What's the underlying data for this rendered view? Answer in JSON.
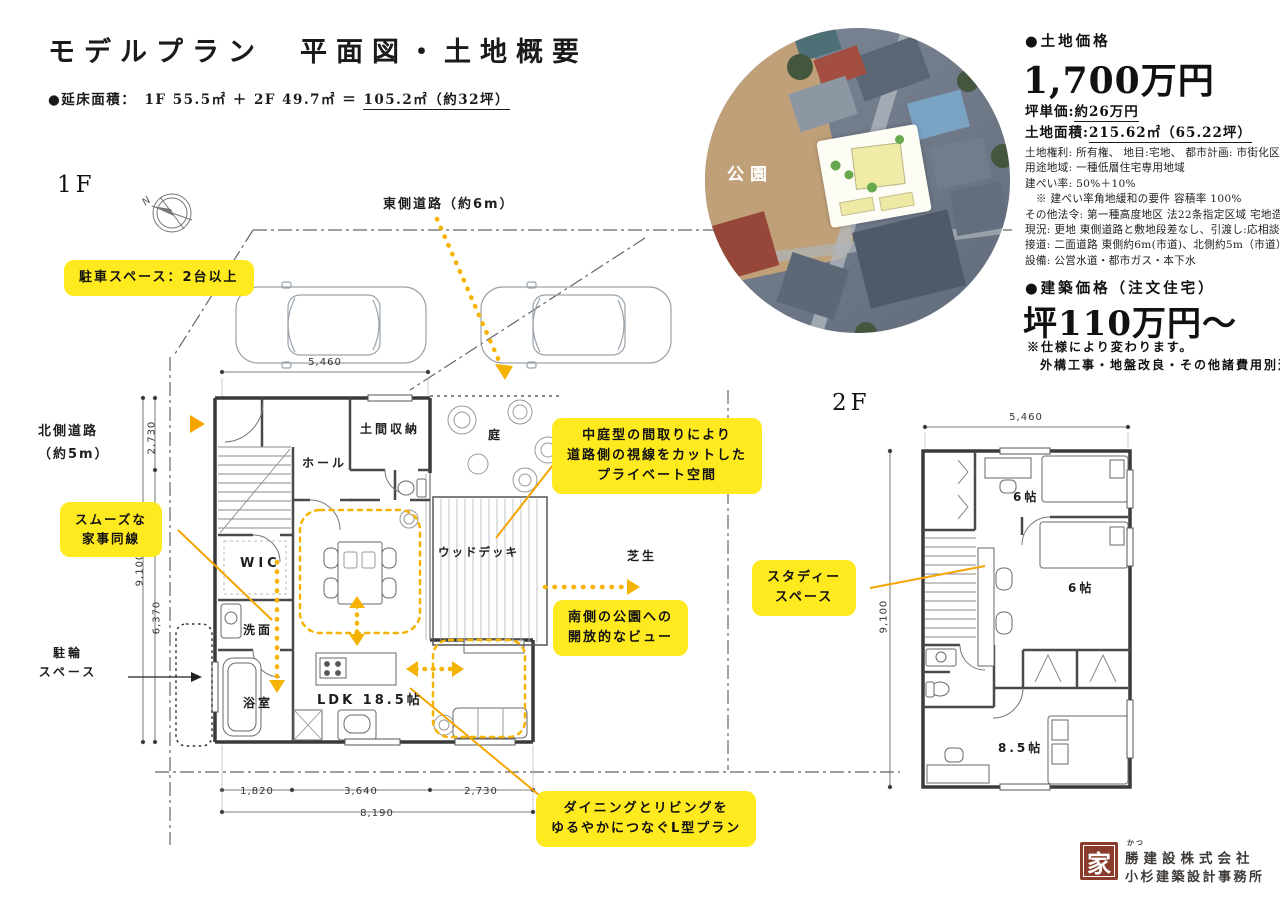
{
  "header": {
    "title": "モデルプラン　平面図・土地概要",
    "floor_area_prefix": "●延床面積：　1F 55.5㎡ ＋ 2F 49.7㎡ ＝ ",
    "floor_area_total": "105.2㎡（約32坪）"
  },
  "land": {
    "section_label": "●土地価格",
    "price": "1,700万円",
    "unit_price_label": "坪単価:",
    "unit_price_value": "約26万円",
    "area_label": "土地面積:",
    "area_value": "215.62㎡",
    "area_tsubo": "（65.22坪）",
    "details": [
      "土地権利: 所有権、 地目:宅地、 都市計画: 市街化区域",
      "用途地域: 一種低層住宅専用地域",
      "建ぺい率: 50%＋10%",
      "　※ 建ぺい率角地緩和の要件 容積率 100%",
      "その他法令: 第一種高度地区 法22条指定区域 宅地造成等規制法",
      "現況: 更地 東側道路と敷地段差なし、引渡し:応相談",
      "接道: 二面道路 東側約6m(市道)、北側約5m（市道）",
      "設備: 公営水道・都市ガス・本下水"
    ]
  },
  "building": {
    "section_label": "●建築価格（注文住宅）",
    "price": "坪110万円〜",
    "note1": "※仕様により変わります。",
    "note2": "外構工事・地盤改良・その他諸費用別途。"
  },
  "site": {
    "road_east": "東側道路（約6m）",
    "road_north_1": "北側道路",
    "road_north_2": "（約5m）",
    "bicycle_1": "駐輪",
    "bicycle_2": "スペース",
    "compass_n": "N"
  },
  "floor1": {
    "label": "1F",
    "rooms": {
      "doma": "土間収納",
      "hall": "ホール",
      "garden": "庭",
      "deck": "ウッドデッキ",
      "wic": "WIC",
      "senmen": "洗面",
      "bath": "浴室",
      "ldk": "LDK 18.5帖",
      "lawn": "芝生"
    },
    "dims": {
      "top": "5,460",
      "left1": "2,730",
      "left2": "9,100",
      "left3": "6,370",
      "b1": "1,820",
      "b2": "3,640",
      "b3": "2,730",
      "b_total": "8,190"
    }
  },
  "floor2": {
    "label": "2F",
    "rooms": {
      "r1": "6帖",
      "r2": "6帖",
      "r3": "8.5帖"
    },
    "dims": {
      "top": "5,460",
      "left": "9,100"
    }
  },
  "callouts": {
    "parking": "駐車スペース：2台以上",
    "kaji_1": "スムーズな",
    "kaji_2": "家事同線",
    "private_1": "中庭型の間取りにより",
    "private_2": "道路側の視線をカットした",
    "private_3": "プライベート空間",
    "view_1": "南側の公園への",
    "view_2": "開放的なビュー",
    "ltype_1": "ダイニングとリビングを",
    "ltype_2": "ゆるやかにつなぐL型プラン",
    "study_1": "スタディー",
    "study_2": "スペース"
  },
  "aerial": {
    "park_label": "公園"
  },
  "logo": {
    "mark": "家",
    "furigana": "かつ",
    "company": "勝建設株式会社",
    "office": "小杉建築設計事務所"
  },
  "colors": {
    "accent_yellow": "#ffe91f",
    "arrow_gold": "#f5b301",
    "logo_red": "#8a3b2b"
  }
}
